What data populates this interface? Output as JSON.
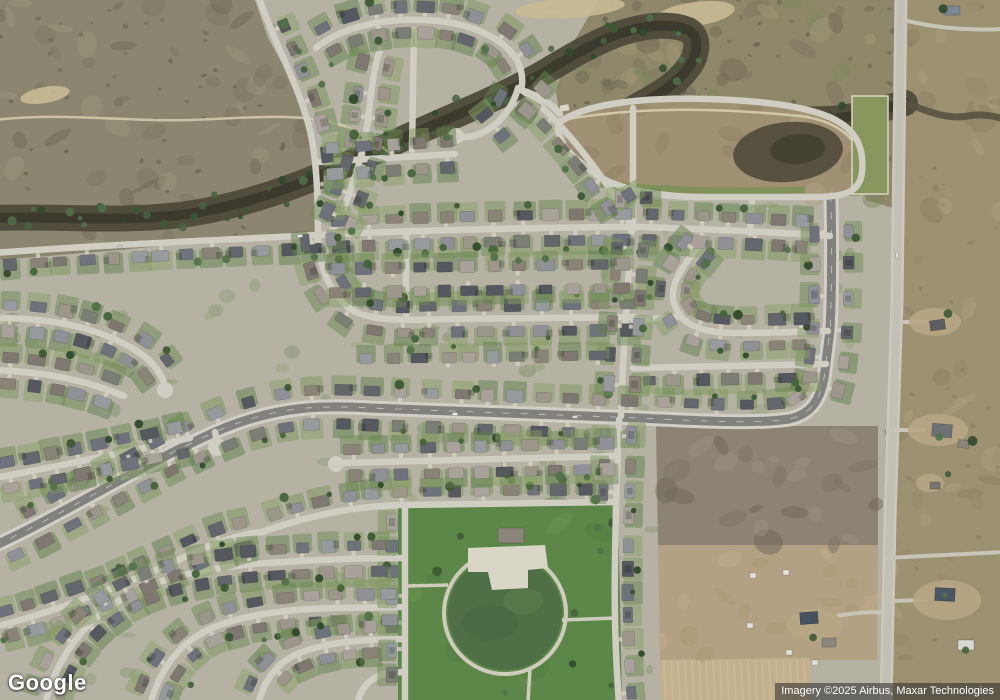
{
  "branding": {
    "logo_text": "Google"
  },
  "attribution": {
    "text": "Imagery ©2025 Airbus, Maxar Technologies"
  },
  "map": {
    "view": "satellite",
    "palette": {
      "base": "#b5b2a4",
      "scrub": "#8c8670",
      "scrub_ne": "#8e8769",
      "pasture_east": "#9c9171",
      "riparian": "#4e4a3a",
      "riparian_core": "#3a382c",
      "basin": "#a09175",
      "basin_pond": "#514c3c",
      "field_brown": "#8d8374",
      "field_tan": "#b3a183",
      "field_plowed": "#c3b18e",
      "park": "#5d8748",
      "park_circle": "#4f7046",
      "path_light": "#cfccbd",
      "street": "#d0cdc3",
      "avenue_asphalt": "#81827e",
      "avenue_walk": "#d2d0c6",
      "rural_road": "#c2bfb4",
      "rural_shoulder": "#ccc8bb",
      "roofs": [
        "#8f9196",
        "#63666b",
        "#9d978b",
        "#55585e",
        "#7e7870",
        "#a8a29a",
        "#8a8478",
        "#6e727a",
        "#979b9e",
        "#7b7e74"
      ],
      "lawns": [
        "#7c965c",
        "#6d8a52",
        "#89a065",
        "#5f7f49"
      ],
      "trees": [
        "#3d5935",
        "#46643c",
        "#2f4a2b",
        "#52714a"
      ],
      "driveway": "#d6d1c3"
    },
    "zones": {
      "scrub_left": [
        [
          0,
          0
        ],
        [
          255,
          0
        ],
        [
          268,
          38
        ],
        [
          296,
          88
        ],
        [
          309,
          138
        ],
        [
          315,
          178
        ],
        [
          316,
          232
        ],
        [
          260,
          236
        ],
        [
          200,
          242
        ],
        [
          120,
          250
        ],
        [
          60,
          255
        ],
        [
          0,
          260
        ]
      ],
      "scrub_ne": [
        [
          598,
          0
        ],
        [
          900,
          0
        ],
        [
          900,
          210
        ],
        [
          866,
          200
        ],
        [
          862,
          150
        ],
        [
          838,
          121
        ],
        [
          800,
          106
        ],
        [
          720,
          98
        ],
        [
          640,
          96
        ],
        [
          560,
          118
        ],
        [
          556,
          92
        ],
        [
          566,
          54
        ],
        [
          582,
          28
        ]
      ],
      "pasture_east": [
        [
          900,
          -5
        ],
        [
          1005,
          -5
        ],
        [
          1005,
          705
        ],
        [
          884,
          705
        ],
        [
          890,
          520
        ],
        [
          897,
          300
        ],
        [
          900,
          140
        ]
      ],
      "basin": [
        [
          560,
          118
        ],
        [
          640,
          98
        ],
        [
          720,
          100
        ],
        [
          800,
          108
        ],
        [
          838,
          122
        ],
        [
          862,
          152
        ],
        [
          860,
          196
        ],
        [
          815,
          196
        ],
        [
          705,
          196
        ],
        [
          640,
          190
        ],
        [
          598,
          176
        ],
        [
          568,
          148
        ]
      ],
      "field_brown": [
        [
          656,
          426
        ],
        [
          878,
          426
        ],
        [
          878,
          545
        ],
        [
          658,
          545
        ]
      ],
      "field_tan": [
        [
          658,
          545
        ],
        [
          878,
          545
        ],
        [
          877,
          660
        ],
        [
          660,
          660
        ]
      ],
      "field_plowed": [
        [
          660,
          660
        ],
        [
          810,
          658
        ],
        [
          810,
          705
        ],
        [
          662,
          705
        ]
      ],
      "fields_all": [
        [
          654,
          424
        ],
        [
          880,
          424
        ],
        [
          880,
          705
        ],
        [
          652,
          705
        ]
      ],
      "park": [
        [
          398,
          502
        ],
        [
          618,
          500
        ],
        [
          622,
          705
        ],
        [
          398,
          705
        ]
      ]
    },
    "riparian_band": "M-5,218 C60,215 140,225 210,210 C280,196 340,168 400,140 C450,117 500,98 545,72 C570,57 590,45 615,35 C640,26 668,22 688,30 C700,36 698,55 688,68 C676,84 662,92 648,100 C662,108 690,108 720,112 C760,117 800,122 840,118 C865,115 885,108 905,103",
    "creek_east": "M903,102 C925,110 945,120 968,116 C984,113 996,117 1005,119",
    "scrub_trail": "M-5,120 C60,112 130,122 190,120 C250,118 300,112 340,125 C365,133 382,148 398,158",
    "basin_trail": "M562,120 C640,106 720,108 800,116 C830,120 850,132 858,150",
    "basin_pond": {
      "cx": 788,
      "cy": 152,
      "rx": 55,
      "ry": 30,
      "rot": -5
    },
    "green_parcel": {
      "x": 852,
      "y": 96,
      "w": 36,
      "h": 98
    },
    "sand_patches": [
      {
        "cx": 570,
        "cy": 8,
        "rx": 55,
        "ry": 10,
        "rot": -4
      },
      {
        "cx": 695,
        "cy": 14,
        "rx": 40,
        "ry": 12,
        "rot": -8
      },
      {
        "cx": 45,
        "cy": 95,
        "rx": 25,
        "ry": 8,
        "rot": -10
      }
    ],
    "park_features": {
      "circle": {
        "cx": 505,
        "cy": 613,
        "r": 57
      },
      "plaza": [
        [
          468,
          548
        ],
        [
          545,
          545
        ],
        [
          548,
          568
        ],
        [
          528,
          570
        ],
        [
          528,
          588
        ],
        [
          492,
          590
        ],
        [
          488,
          572
        ],
        [
          468,
          572
        ]
      ],
      "shelter": {
        "x": 498,
        "y": 528,
        "w": 26,
        "h": 15
      },
      "spurs": [
        "M448,585 L405,586",
        "M530,668 L528,702",
        "M562,620 L616,618"
      ]
    },
    "streets": [
      {
        "id": "rural-road",
        "d": "M901,-5 L897,300 L890,520 L886,705",
        "kind": "rural",
        "houses": "none"
      },
      {
        "id": "avenue",
        "d": "M-6,546 C60,516 140,466 215,432 C275,406 320,405 370,408 L640,418 C700,421 758,424 789,419 C813,414 822,397 825,371 L830,330 C832,290 832,250 831,200",
        "kind": "avenue",
        "houses": "both",
        "gap": 30,
        "setback": 17
      },
      {
        "id": "north-ew",
        "d": "M-6,253 C100,245 200,241 318,235 C420,230 560,227 642,227 C700,229 775,232 830,236",
        "houses": "both"
      },
      {
        "id": "collector",
        "d": "M258,-6 C272,40 300,85 311,135 C317,165 318,200 318,240 C320,268 330,295 352,310 C372,322 410,320 450,319 L636,317",
        "houses": "both"
      },
      {
        "id": "pond-loop",
        "d": "M560,122 C585,104 640,97 710,99 C770,101 816,108 839,122 C859,134 864,152 862,172 C860,192 845,197 815,197 L705,197 C665,197 620,191 597,175 C574,159 552,140 560,122 Z",
        "houses": "none"
      },
      {
        "id": "basin-south-stub",
        "d": "M752,198 L750,233",
        "houses": "none"
      },
      {
        "id": "serpentine",
        "d": "M705,238 C695,252 685,262 678,276 C670,292 672,304 680,315 C690,330 715,334 750,333 L828,331",
        "houses": "both"
      },
      {
        "id": "ew-right-b",
        "d": "M633,368 L826,364",
        "houses": "plus"
      },
      {
        "id": "ew-right-a",
        "d": "M633,320 L678,317",
        "houses": "none"
      },
      {
        "id": "ne-vert",
        "d": "M633,108 L633,230",
        "houses": "both"
      },
      {
        "id": "mid-vert",
        "d": "M631,232 L627,300 C624,345 622,380 621,416",
        "houses": "both"
      },
      {
        "id": "park-east-st",
        "d": "M619,420 L616,505 L615,560 C614,620 616,660 619,705",
        "houses": "both"
      },
      {
        "id": "v406",
        "d": "M406,232 L406,317",
        "houses": "none"
      },
      {
        "id": "row-278",
        "d": "M322,281 L634,276",
        "draw": false,
        "houses": "both",
        "setback": 12
      },
      {
        "id": "row-370",
        "d": "M352,372 L634,368",
        "draw": false,
        "houses": "minus"
      },
      {
        "id": "nw-st",
        "d": "M-6,318 C60,318 100,330 132,348 C152,360 161,372 165,386",
        "houses": "both"
      },
      {
        "id": "n1",
        "d": "M316,48 C340,28 380,18 425,20 C470,22 505,38 518,62 C523,74 523,83 521,90",
        "houses": "both"
      },
      {
        "id": "n1e",
        "d": "M521,90 C540,96 552,104 560,114",
        "houses": "none"
      },
      {
        "id": "n2",
        "d": "M332,231 C350,200 362,160 368,120 C371,95 373,70 380,50",
        "houses": "both"
      },
      {
        "id": "n3",
        "d": "M518,88 C512,110 498,125 482,133 C473,137 464,138 458,136",
        "houses": "both",
        "gap": 30
      },
      {
        "id": "n4",
        "d": "M522,90 C560,120 590,160 612,192 C622,207 629,219 632,229",
        "houses": "both"
      },
      {
        "id": "p-ew",
        "d": "M318,162 L455,154",
        "houses": "both"
      },
      {
        "id": "o-vert",
        "d": "M414,30 L412,150",
        "houses": "none"
      },
      {
        "id": "park-north-st",
        "d": "M262,532 C320,512 360,506 405,505 L616,502",
        "houses": "minus"
      },
      {
        "id": "park-west-st",
        "d": "M405,505 L405,705",
        "houses": "plus"
      },
      {
        "id": "sw1",
        "d": "M-6,370 C50,372 90,382 124,396",
        "houses": "both"
      },
      {
        "id": "sw2",
        "d": "M-6,478 C60,466 130,451 190,438",
        "houses": "both"
      },
      {
        "id": "sw3",
        "d": "M-6,627 C70,608 140,578 200,550 C230,537 250,533 262,532",
        "houses": "both"
      },
      {
        "id": "sw4",
        "d": "M45,705 C55,662 80,625 120,600 C160,576 210,568 255,564 C310,560 360,558 404,558",
        "houses": "both"
      },
      {
        "id": "sw5",
        "d": "M150,705 C160,668 180,642 212,628 C245,614 290,609 335,608 L404,607",
        "houses": "both"
      },
      {
        "id": "sw6",
        "d": "M258,705 C264,678 280,660 302,652 C332,641 370,639 404,639",
        "houses": "both"
      },
      {
        "id": "sw7",
        "d": "M357,705 C360,688 370,677 388,673 L404,672",
        "houses": "none"
      },
      {
        "id": "se-st",
        "d": "M338,463 L616,456",
        "houses": "both"
      },
      {
        "id": "stub-217",
        "d": "M215,432 L217,441",
        "houses": "none"
      }
    ],
    "cul_de_sacs": [
      {
        "x": 217,
        "y": 447,
        "r": 9
      },
      {
        "x": 165,
        "y": 390,
        "r": 8
      },
      {
        "x": 456,
        "y": 136,
        "r": 8
      },
      {
        "x": 336,
        "y": 464,
        "r": 8
      }
    ],
    "farm_roads": [
      "M884,558 L1005,552",
      "M903,20 C928,26 958,31 1005,29",
      "M886,430 L925,430",
      "M887,601 L928,600",
      "M836,616 C860,612 876,611 888,613",
      "M900,322 L930,322"
    ],
    "farm_pads": [
      {
        "cx": 935,
        "cy": 322,
        "rx": 26,
        "ry": 14
      },
      {
        "cx": 938,
        "cy": 430,
        "rx": 30,
        "ry": 16
      },
      {
        "cx": 947,
        "cy": 600,
        "rx": 34,
        "ry": 20
      },
      {
        "cx": 815,
        "cy": 625,
        "rx": 28,
        "ry": 16
      },
      {
        "cx": 930,
        "cy": 483,
        "rx": 14,
        "ry": 9
      }
    ],
    "farm_buildings": [
      {
        "x": 944,
        "y": 6,
        "w": 16,
        "h": 9,
        "rot": 0,
        "color": "#7a8894"
      },
      {
        "x": 930,
        "y": 320,
        "w": 15,
        "h": 10,
        "rot": -8,
        "color": "#5b5e63"
      },
      {
        "x": 932,
        "y": 424,
        "w": 20,
        "h": 13,
        "rot": 5,
        "color": "#6e7074"
      },
      {
        "x": 958,
        "y": 440,
        "w": 11,
        "h": 8,
        "rot": 5,
        "color": "#8d8579"
      },
      {
        "x": 930,
        "y": 482,
        "w": 10,
        "h": 7,
        "rot": 0,
        "color": "#7a766d"
      },
      {
        "x": 935,
        "y": 588,
        "w": 20,
        "h": 13,
        "rot": 3,
        "color": "#4a5663"
      },
      {
        "x": 958,
        "y": 640,
        "w": 16,
        "h": 10,
        "rot": 0,
        "color": "#d8d8d2"
      },
      {
        "x": 800,
        "y": 612,
        "w": 18,
        "h": 12,
        "rot": -4,
        "color": "#46525f"
      },
      {
        "x": 822,
        "y": 638,
        "w": 14,
        "h": 9,
        "rot": 0,
        "color": "#8b887e"
      }
    ],
    "field_sheds": [
      {
        "x": 750,
        "y": 573
      },
      {
        "x": 783,
        "y": 570
      },
      {
        "x": 747,
        "y": 623
      },
      {
        "x": 786,
        "y": 650
      },
      {
        "x": 812,
        "y": 660
      }
    ],
    "vehicles": [
      {
        "x": 455,
        "y": 414,
        "rot": 2,
        "color": "#ecebe5"
      },
      {
        "x": 575,
        "y": 417,
        "rot": 1,
        "color": "#d9d8d1"
      },
      {
        "x": 300,
        "y": 236,
        "rot": -2,
        "color": "#e8e6df"
      },
      {
        "x": 897,
        "y": 255,
        "rot": 88,
        "color": "#dcdad2"
      },
      {
        "x": 120,
        "y": 247,
        "rot": -3,
        "color": "#c9c7c0"
      }
    ]
  }
}
